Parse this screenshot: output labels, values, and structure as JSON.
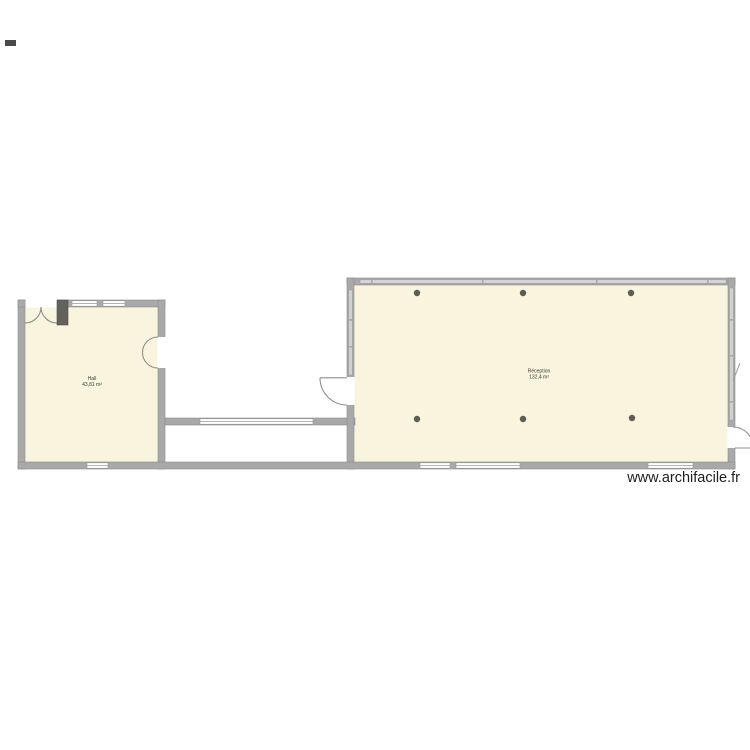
{
  "watermark": {
    "text": "www.archifacile.fr"
  },
  "rooms": [
    {
      "name": "Hall",
      "area": "43,81 m²"
    },
    {
      "name": "Réception",
      "area": "132,4 m²"
    }
  ],
  "plan": {
    "colors": {
      "room_fill": "#f8f4de",
      "wall": "#a9a9a9",
      "wall_edge": "#8c8c8c",
      "window": "#ffffff",
      "post": "#5d5d56",
      "label_text": "#3a3a3a",
      "watermark_text": "#1f1f1f"
    },
    "post_count": 6
  }
}
